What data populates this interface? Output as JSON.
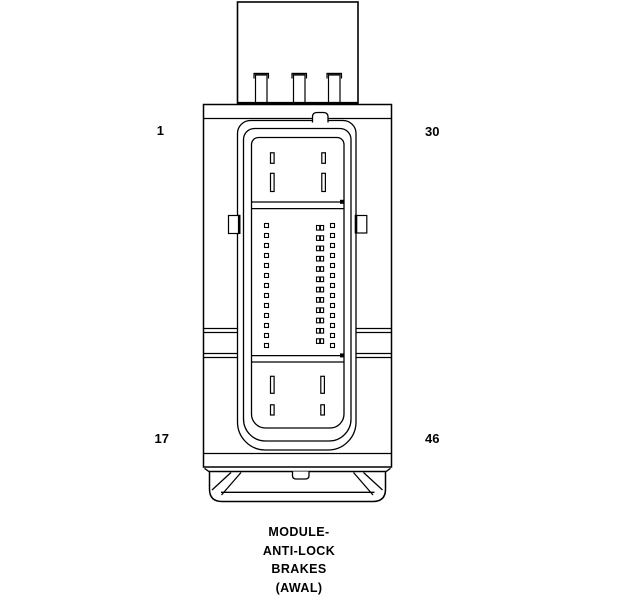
{
  "diagram": {
    "title_caption": {
      "lines": [
        "MODULE-",
        "ANTI-LOCK",
        "BRAKES",
        "(AWAL)"
      ]
    },
    "corner_labels": {
      "top_left": "1",
      "top_right": "30",
      "bottom_left": "17",
      "bottom_right": "46"
    },
    "colors": {
      "line": "#000000",
      "background": "#ffffff"
    },
    "pin_field": {
      "left_column": {
        "count": 13,
        "x": 264.5,
        "y_start": 223.5,
        "y_step": 10.0,
        "size": 4
      },
      "right_column": {
        "count": 13,
        "x": 330.5,
        "y_start": 223.5,
        "y_step": 10.0,
        "size": 4
      },
      "middle_column": {
        "count": 12,
        "x": 316.5,
        "y_start": 225.5,
        "y_step": 10.3,
        "half_w": 3.2,
        "h": 4.6,
        "gap": 3.9
      }
    }
  }
}
